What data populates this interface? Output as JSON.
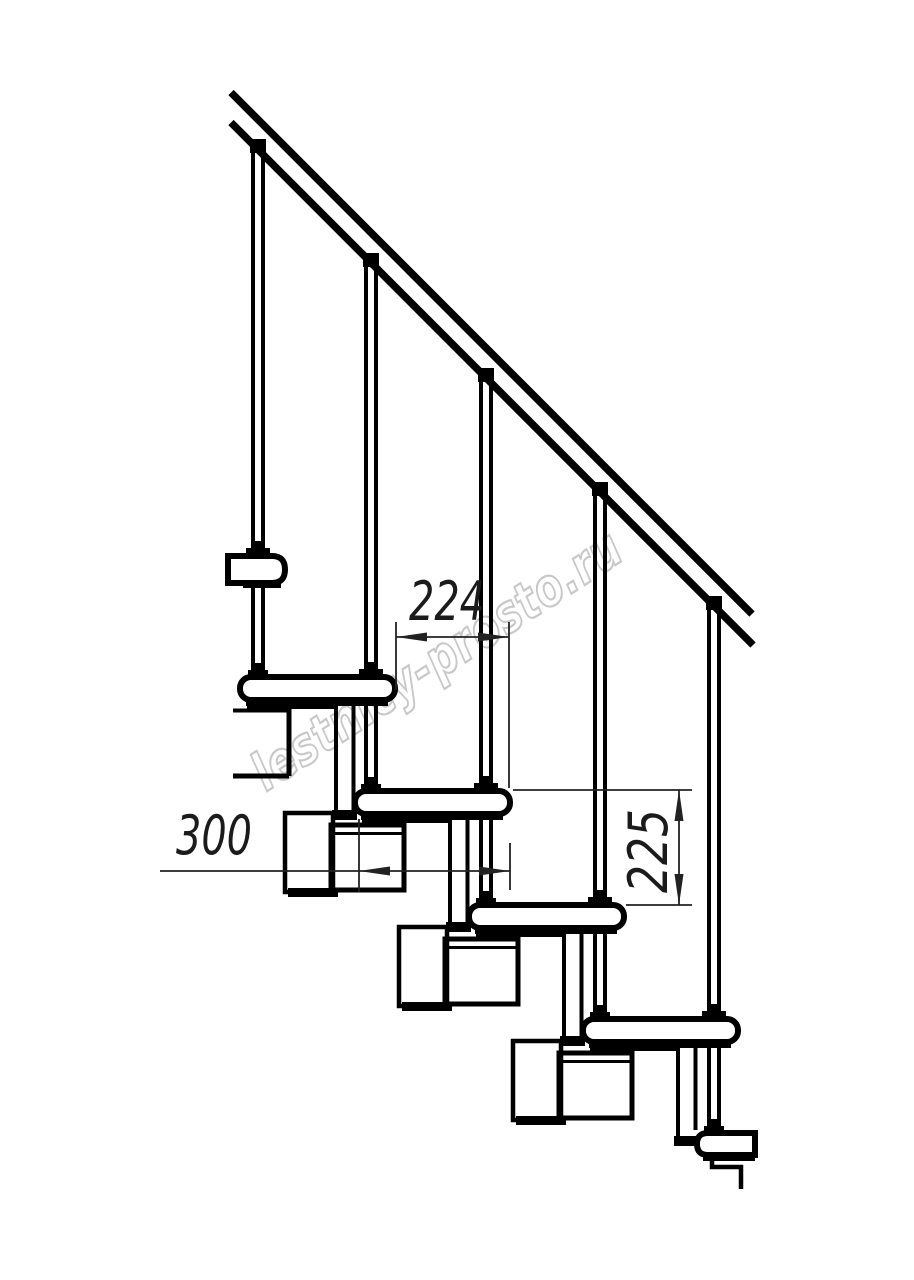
{
  "page": {
    "width": 914,
    "height": 1280,
    "background": "#ffffff"
  },
  "drawing": {
    "description": "Side-view technical line drawing of a modular staircase: diagonal handrail, five balusters, five overlapping treads with step modules",
    "line_color": "#000000",
    "dimension_color": "#222222",
    "text_color": "#1b1b1b",
    "tread_count": 5,
    "baluster_count": 5
  },
  "dimensions": {
    "tread_run": "224",
    "tread_depth": "300",
    "riser_height": "225"
  },
  "watermark": {
    "text": "lestnicy-prosto.ru",
    "color": "#c8c8c8"
  }
}
